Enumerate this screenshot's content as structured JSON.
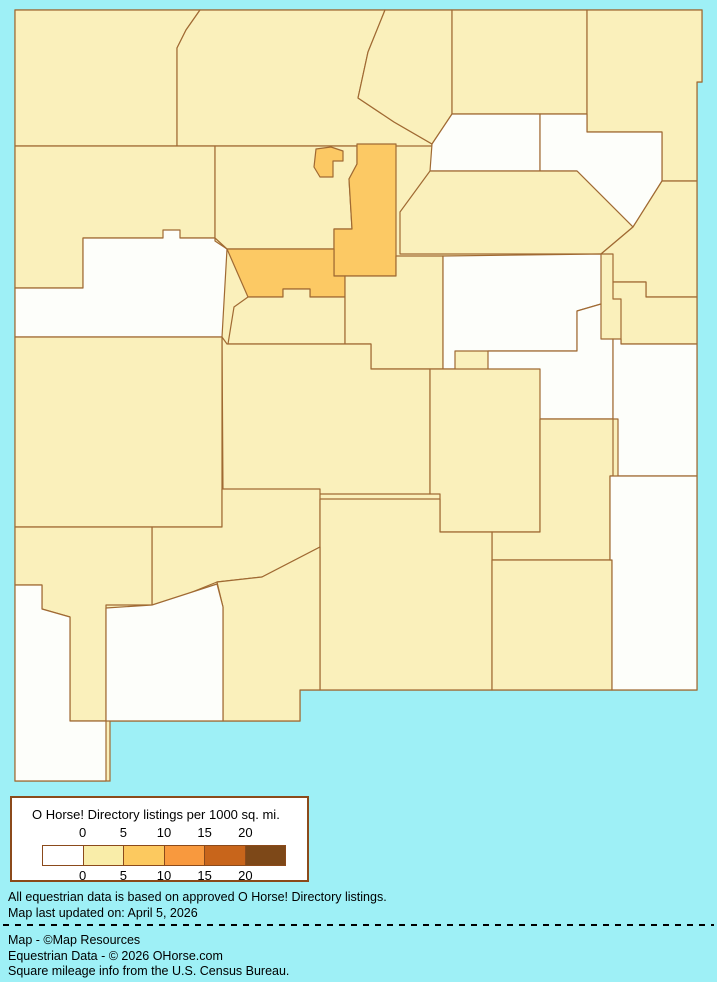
{
  "colors": {
    "background": "#9EF0F6",
    "county_border": "#A06A33",
    "class_0": "#FDFEFA",
    "class_0_5": "#FAF0BB",
    "class_5_10": "#FCC964",
    "legend_border": "#8B4A1B",
    "legend_bg": "#FFFFFF",
    "text": "#000000"
  },
  "legend": {
    "title": "O Horse! Directory listings per 1000 sq. mi.",
    "tick_labels": [
      "0",
      "5",
      "10",
      "15",
      "20"
    ],
    "swatch_colors": [
      "#FFFFFF",
      "#F9EDA9",
      "#FCC95F",
      "#F8993E",
      "#C8651B",
      "#7D4818"
    ]
  },
  "notes": [
    "All equestrian data is based on approved O Horse! Directory listings.",
    "Map last updated on: April 5, 2026"
  ],
  "credits": [
    "Map - ©Map Resources",
    "Equestrian Data - © 2026 OHorse.com",
    "Square mileage info from the U.S. Census Bureau."
  ],
  "map": {
    "state": "New Mexico",
    "outline_points": "15,10 702,10 702,82 697,82 697,690 300,690 300,721 110,721 110,781 15,781",
    "counties": [
      {
        "name": "San Juan",
        "listings_class": "0-5",
        "points": "15,10 200,10 186,30 177,48 177,146 15,146"
      },
      {
        "name": "Rio Arriba",
        "listings_class": "0-5",
        "points": "200,10 385,10 368,52 358,98 394,122 432,144 432,146 177,146 177,48 186,30"
      },
      {
        "name": "Taos",
        "listings_class": "0-5",
        "points": "385,10 452,10 452,114 432,144 394,122 358,98 368,52"
      },
      {
        "name": "Colfax",
        "listings_class": "0-5",
        "points": "452,10 587,10 587,114 452,114"
      },
      {
        "name": "Union",
        "listings_class": "0-5",
        "points": "587,10 702,10 702,82 697,82 697,181 662,181 662,132 587,132"
      },
      {
        "name": "Mora",
        "listings_class": "0",
        "points": "452,114 540,114 540,171 430,171 432,144"
      },
      {
        "name": "Harding",
        "listings_class": "0",
        "points": "540,114 587,114 587,132 662,132 662,181 633,227 577,171 540,171"
      },
      {
        "name": "San Miguel",
        "listings_class": "0-5",
        "points": "430,171 577,171 633,227 601,254 400,254 400,212"
      },
      {
        "name": "Quay",
        "listings_class": "0-5",
        "points": "633,227 662,181 697,181 697,297 646,297 646,282 613,282 613,254 601,254"
      },
      {
        "name": "Curry",
        "listings_class": "0-5",
        "points": "613,282 646,282 646,297 697,297 697,344 621,344 621,299 613,299"
      },
      {
        "name": "McKinley",
        "listings_class": "0-5",
        "points": "15,146 215,146 215,238 83,238 83,288 15,288"
      },
      {
        "name": "Cibola",
        "listings_class": "0",
        "points": "83,238 163,238 163,230 180,230 180,238 215,238 215,241 227,249 222,337 15,337 15,288 83,288"
      },
      {
        "name": "Sandoval",
        "listings_class": "0-5",
        "points": "215,146 357,146 357,164 349,179 352,229 334,229 334,249 227,249 215,238"
      },
      {
        "name": "Santa Fe",
        "listings_class": "5-10",
        "points": "357,144 396,144 396,276 334,276 334,229 352,229 349,179 357,164"
      },
      {
        "name": "Los Alamos",
        "listings_class": "5-10",
        "points": "316,149 331,147 343,151 343,161 333,161 333,177 320,177 314,167"
      },
      {
        "name": "Bernalillo",
        "listings_class": "5-10",
        "points": "227,249 334,249 334,276 345,276 345,297 310,297 310,289 283,289 283,297 248,297"
      },
      {
        "name": "Valencia",
        "listings_class": "0-5",
        "points": "248,297 283,297 283,289 310,289 310,297 345,297 345,344 228,344 234,307"
      },
      {
        "name": "Torrance",
        "listings_class": "0-5",
        "points": "345,276 396,276 396,256 443,256 443,369 371,369 371,344 345,344"
      },
      {
        "name": "Guadalupe",
        "listings_class": "0",
        "points": "443,256 601,254 601,304 577,311 577,351 455,351 455,369 443,369"
      },
      {
        "name": "De Baca",
        "listings_class": "0",
        "points": "488,351 577,351 577,311 601,304 601,339 613,339 613,419 488,419"
      },
      {
        "name": "Roosevelt",
        "listings_class": "0",
        "points": "613,339 621,339 621,344 697,344 697,476 618,476 618,419 613,419"
      },
      {
        "name": "Socorro",
        "listings_class": "0-5",
        "points": "222,337 227,344 345,344 371,344 371,369 430,369 430,494 223,494"
      },
      {
        "name": "Catron",
        "listings_class": "0-5",
        "points": "15,337 222,337 222,527 15,527"
      },
      {
        "name": "Lincoln",
        "listings_class": "0-5",
        "points": "430,369 540,369 540,532 440,532 440,494 430,494"
      },
      {
        "name": "Chaves",
        "listings_class": "0-5",
        "points": "540,419 613,419 613,476 610,476 610,560 492,560 492,532 540,532"
      },
      {
        "name": "Sierra",
        "listings_class": "0-5",
        "points": "222,489 320,489 320,547 262,577 217,582 160,605 152,605 152,527 222,527"
      },
      {
        "name": "Otero",
        "listings_class": "0-5",
        "points": "320,499 440,499 440,532 492,532 492,690 320,690 320,547"
      },
      {
        "name": "Dona Ana",
        "listings_class": "0-5",
        "points": "320,547 320,690 300,690 300,721 223,721 223,607 217,582 262,577"
      },
      {
        "name": "Grant",
        "listings_class": "0-5",
        "points": "15,527 152,527 152,605 106,605 106,721 70,721 70,617 42,609 42,585 15,585"
      },
      {
        "name": "Hidalgo",
        "listings_class": "0",
        "points": "15,585 42,585 42,609 70,617 70,721 106,721 106,781 15,781"
      },
      {
        "name": "Luna",
        "listings_class": "0",
        "points": "106,608 152,605 217,584 223,607 223,721 106,721"
      },
      {
        "name": "Eddy",
        "listings_class": "0-5",
        "points": "492,560 612,560 612,690 492,690"
      },
      {
        "name": "Lea",
        "listings_class": "0",
        "points": "618,476 697,476 697,690 612,690 612,560 610,560 610,476"
      }
    ]
  }
}
